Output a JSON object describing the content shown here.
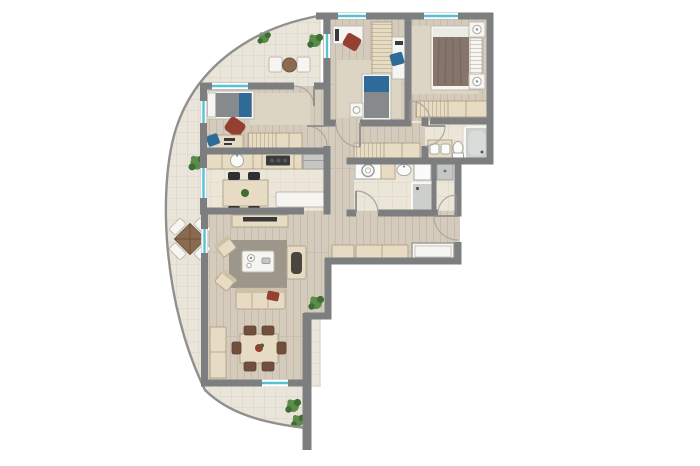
{
  "title": "apartment-floor-plan",
  "palette": {
    "bg": "#ffffff",
    "wall": "#7d7e80",
    "curve_line": "#90908d",
    "wood": "#d4cbbc",
    "wood_stripe": "#c6bcab",
    "tile": "#ece6d9",
    "tile_line": "#ddd5c4",
    "balcony_tile": "#eae5da",
    "balcony_line": "#dcd4c2",
    "furn_beige": "#e7dcc3",
    "furn_border": "#b3a68b",
    "furn_white": "#f6f5f1",
    "furn_white_border": "#bfbab0",
    "rug_living": "#9d978b",
    "rug_beige": "#ddd5c4",
    "blanket_gray": "#868a8d",
    "blanket_brown": "#85756a",
    "accent_blue": "#2f6b99",
    "accent_red": "#953f31",
    "chair_black": "#2f2f31",
    "chair_brown": "#70503c",
    "table_wood": "#8a6b4f",
    "plant": "#5c8c4c",
    "plant_dark": "#3e6e33",
    "window_teal": "#56c2d2",
    "appliance": "#c5c7c5"
  },
  "rooms": [
    {
      "id": "bedroom-left",
      "floor": "wood",
      "furniture": [
        "single-bed",
        "rug",
        "bean-chair",
        "desk",
        "desk-chair",
        "dresser"
      ]
    },
    {
      "id": "bedroom-middle",
      "floor": "wood",
      "furniture": [
        "desk-with-monitor",
        "office-chair",
        "wardrobe",
        "side-desk",
        "side-chair",
        "single-bed",
        "nightstand"
      ]
    },
    {
      "id": "master-bedroom",
      "floor": "wood",
      "furniture": [
        "double-bed",
        "nightstand-left",
        "nightstand-right",
        "rug",
        "wardrobe"
      ]
    },
    {
      "id": "bathroom",
      "floor": "tile",
      "furniture": [
        "double-vanity",
        "toilet",
        "bathtub"
      ]
    },
    {
      "id": "shower-room",
      "floor": "tile",
      "furniture": [
        "washer-counter",
        "basin",
        "cabinet",
        "shower"
      ]
    },
    {
      "id": "wc-niche",
      "floor": "tile",
      "furniture": [
        "utility-cabinet"
      ]
    },
    {
      "id": "kitchen",
      "floor": "tile",
      "furniture": [
        "counter-with-sink",
        "cooktop",
        "fridge",
        "kitchen-table",
        "four-black-chairs",
        "window-bench"
      ]
    },
    {
      "id": "hallway",
      "floor": "wood",
      "furniture": [
        "hall-closet",
        "shoe-cabinet-small",
        "shoe-cabinet-large",
        "built-in-closet"
      ]
    },
    {
      "id": "living-room",
      "floor": "wood",
      "furniture": [
        "tv-sideboard",
        "rug",
        "coffee-table",
        "armchair-upper",
        "armchair-lower",
        "accent-chair",
        "sofa",
        "plant"
      ]
    },
    {
      "id": "dining-area",
      "floor": "wood",
      "furniture": [
        "sideboard",
        "dining-table",
        "six-brown-chairs"
      ]
    },
    {
      "id": "balcony-top",
      "floor": "balcony-tile",
      "furniture": [
        "two-chairs",
        "round-table",
        "plants"
      ]
    },
    {
      "id": "balcony-left",
      "floor": "balcony-tile",
      "furniture": [
        "square-table-set",
        "plant"
      ]
    },
    {
      "id": "balcony-bottom",
      "floor": "balcony-tile",
      "furniture": [
        "plants"
      ]
    }
  ],
  "openings": {
    "windows": 8,
    "doors": [
      "balcony-door-bedroom-left",
      "bedroom-left-door",
      "bedroom-middle-door",
      "master-door",
      "bathroom-door",
      "shower-room-door",
      "wc-door",
      "entry-door"
    ]
  }
}
